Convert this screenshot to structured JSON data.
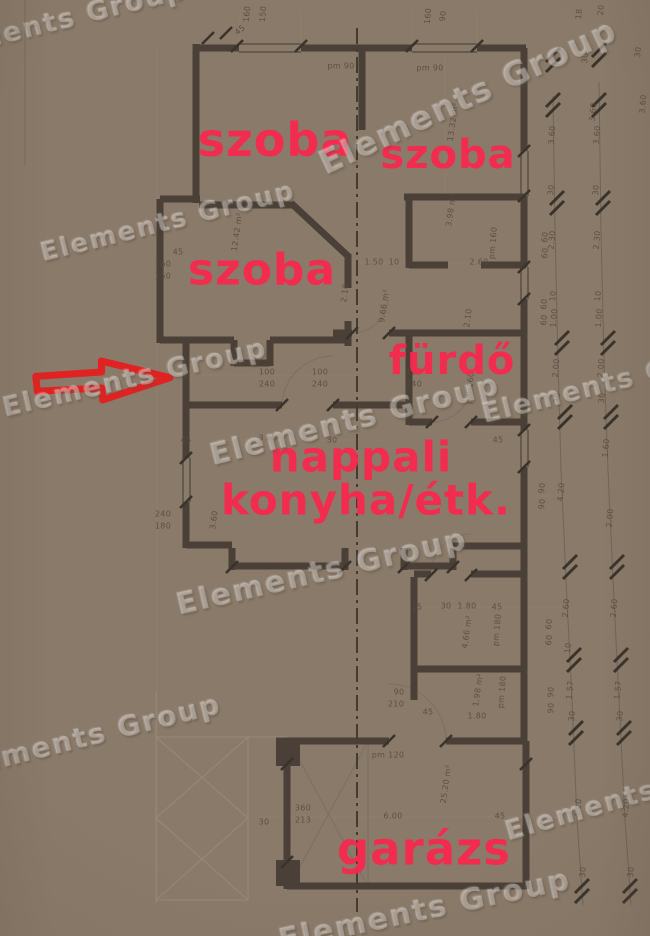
{
  "image": {
    "kind": "photographed floor plan",
    "width": 650,
    "height": 936
  },
  "watermark": {
    "text": "Elements Group",
    "instances": [
      {
        "x": 55,
        "y": 22,
        "r": -14,
        "s": 27
      },
      {
        "x": 468,
        "y": 96,
        "r": -25,
        "s": 33
      },
      {
        "x": 168,
        "y": 222,
        "r": -14,
        "s": 26
      },
      {
        "x": 135,
        "y": 378,
        "r": -13,
        "s": 27
      },
      {
        "x": 355,
        "y": 420,
        "r": -14,
        "s": 30
      },
      {
        "x": 614,
        "y": 382,
        "r": -14,
        "s": 27
      },
      {
        "x": 322,
        "y": 572,
        "r": -13,
        "s": 30
      },
      {
        "x": 85,
        "y": 737,
        "r": -14,
        "s": 28
      },
      {
        "x": 636,
        "y": 795,
        "r": -16,
        "s": 27
      },
      {
        "x": 425,
        "y": 910,
        "r": -12,
        "s": 30
      }
    ]
  },
  "plan": {
    "room_labels": [
      {
        "t": "szoba",
        "x": 275,
        "y": 140,
        "s": 46
      },
      {
        "t": "szoba",
        "x": 448,
        "y": 155,
        "s": 40
      },
      {
        "t": "szoba",
        "x": 262,
        "y": 270,
        "s": 44
      },
      {
        "t": "fürdő",
        "x": 452,
        "y": 361,
        "s": 40
      },
      {
        "t": "nappali",
        "x": 361,
        "y": 457,
        "s": 42
      },
      {
        "t": "konyha/étk.",
        "x": 366,
        "y": 500,
        "s": 42
      },
      {
        "t": "garázs",
        "x": 424,
        "y": 849,
        "s": 45
      }
    ],
    "annotation_arrow": {
      "color": "#e51f1f",
      "direction": "right"
    },
    "colors": {
      "paper": "#c8b7a5",
      "wall": "#4a4037",
      "thin_line": "#8f8171",
      "pencil": "#978b7d",
      "dim_text": "#564a3c",
      "label_red": "#f8284e"
    },
    "dim_labels": [
      {
        "t": "160",
        "x": 247,
        "y": 14,
        "r": -85
      },
      {
        "t": "150",
        "x": 263,
        "y": 14,
        "r": -85
      },
      {
        "t": "45",
        "x": 240,
        "y": 30,
        "r": -40
      },
      {
        "t": "160",
        "x": 428,
        "y": 16,
        "r": -85
      },
      {
        "t": "90",
        "x": 443,
        "y": 16,
        "r": -85
      },
      {
        "t": "pm 90",
        "x": 341,
        "y": 66
      },
      {
        "t": "pm 90",
        "x": 430,
        "y": 68
      },
      {
        "t": "18",
        "x": 579,
        "y": 14,
        "r": -85
      },
      {
        "t": "20",
        "x": 601,
        "y": 10,
        "r": -85
      },
      {
        "t": "30",
        "x": 585,
        "y": 58,
        "r": -85
      },
      {
        "t": "3.60",
        "x": 593,
        "y": 112,
        "r": -85
      },
      {
        "t": "30",
        "x": 638,
        "y": 52,
        "r": -85
      },
      {
        "t": "3.60",
        "x": 643,
        "y": 104,
        "r": -85
      },
      {
        "t": "12.42 m²",
        "x": 237,
        "y": 232,
        "r": -82
      },
      {
        "t": "13.32 m²",
        "x": 453,
        "y": 122,
        "r": -82
      },
      {
        "t": "3.98 m²",
        "x": 451,
        "y": 210,
        "r": -82
      },
      {
        "t": "9.66 m²",
        "x": 384,
        "y": 306,
        "r": -82
      },
      {
        "t": "45",
        "x": 178,
        "y": 252
      },
      {
        "t": "160",
        "x": 163,
        "y": 264
      },
      {
        "t": "150",
        "x": 163,
        "y": 276
      },
      {
        "t": "1.50",
        "x": 374,
        "y": 262
      },
      {
        "t": "10",
        "x": 394,
        "y": 262
      },
      {
        "t": "2.60",
        "x": 479,
        "y": 262
      },
      {
        "t": "pm 160",
        "x": 493,
        "y": 243,
        "r": -85
      },
      {
        "t": "2.10",
        "x": 345,
        "y": 293,
        "r": -82
      },
      {
        "t": "2.10",
        "x": 468,
        "y": 318,
        "r": -82
      },
      {
        "t": "pm 160",
        "x": 470,
        "y": 388,
        "r": -85
      },
      {
        "t": "100",
        "x": 267,
        "y": 372
      },
      {
        "t": "240",
        "x": 267,
        "y": 384
      },
      {
        "t": "100",
        "x": 320,
        "y": 372
      },
      {
        "t": "240",
        "x": 320,
        "y": 384
      },
      {
        "t": "100",
        "x": 414,
        "y": 372
      },
      {
        "t": "240",
        "x": 414,
        "y": 384
      },
      {
        "t": "45",
        "x": 186,
        "y": 440
      },
      {
        "t": "3.60",
        "x": 268,
        "y": 438
      },
      {
        "t": "30",
        "x": 332,
        "y": 440
      },
      {
        "t": "45",
        "x": 498,
        "y": 440
      },
      {
        "t": "240",
        "x": 163,
        "y": 514
      },
      {
        "t": "180",
        "x": 163,
        "y": 526
      },
      {
        "t": "3.60",
        "x": 214,
        "y": 520,
        "r": -82
      },
      {
        "t": "15",
        "x": 417,
        "y": 607
      },
      {
        "t": "30",
        "x": 446,
        "y": 606
      },
      {
        "t": "1.80",
        "x": 467,
        "y": 606
      },
      {
        "t": "45",
        "x": 497,
        "y": 607
      },
      {
        "t": "4.66 m²",
        "x": 467,
        "y": 632,
        "r": -82
      },
      {
        "t": "pm 180",
        "x": 497,
        "y": 630,
        "r": -85
      },
      {
        "t": "1.98 m²",
        "x": 478,
        "y": 690,
        "r": -82
      },
      {
        "t": "pm 180",
        "x": 502,
        "y": 692,
        "r": -85
      },
      {
        "t": "90",
        "x": 399,
        "y": 692
      },
      {
        "t": "210",
        "x": 396,
        "y": 704
      },
      {
        "t": "45",
        "x": 428,
        "y": 712
      },
      {
        "t": "1.80",
        "x": 477,
        "y": 716
      },
      {
        "t": "pm 120",
        "x": 388,
        "y": 755
      },
      {
        "t": "25.20 m²",
        "x": 446,
        "y": 784,
        "r": -82
      },
      {
        "t": "360",
        "x": 303,
        "y": 808
      },
      {
        "t": "213",
        "x": 303,
        "y": 820
      },
      {
        "t": "30",
        "x": 264,
        "y": 822
      },
      {
        "t": "6.00",
        "x": 393,
        "y": 816
      },
      {
        "t": "45",
        "x": 500,
        "y": 816
      },
      {
        "t": "60",
        "x": 545,
        "y": 237,
        "r": -85
      },
      {
        "t": "60",
        "x": 545,
        "y": 253,
        "r": -85
      },
      {
        "t": "60",
        "x": 544,
        "y": 304,
        "r": -85
      },
      {
        "t": "60",
        "x": 544,
        "y": 320,
        "r": -85
      },
      {
        "t": "90",
        "x": 542,
        "y": 488,
        "r": -85
      },
      {
        "t": "90",
        "x": 542,
        "y": 504,
        "r": -85
      },
      {
        "t": "60",
        "x": 549,
        "y": 624,
        "r": -85
      },
      {
        "t": "60",
        "x": 549,
        "y": 640,
        "r": -85
      },
      {
        "t": "90",
        "x": 551,
        "y": 692,
        "r": -85
      },
      {
        "t": "90",
        "x": 551,
        "y": 708,
        "r": -85
      },
      {
        "t": "3.60",
        "x": 552,
        "y": 135,
        "r": -85
      },
      {
        "t": "30",
        "x": 551,
        "y": 190,
        "r": -85
      },
      {
        "t": "2.30",
        "x": 552,
        "y": 240,
        "r": -85
      },
      {
        "t": "10",
        "x": 553,
        "y": 296,
        "r": -85
      },
      {
        "t": "1.00",
        "x": 554,
        "y": 318,
        "r": -85
      },
      {
        "t": "2.00",
        "x": 556,
        "y": 368,
        "r": -85
      },
      {
        "t": "30",
        "x": 557,
        "y": 398,
        "r": -85
      },
      {
        "t": "4.20",
        "x": 561,
        "y": 492,
        "r": -85
      },
      {
        "t": "2.60",
        "x": 566,
        "y": 608,
        "r": -85
      },
      {
        "t": "10",
        "x": 568,
        "y": 648,
        "r": -85
      },
      {
        "t": "1.57",
        "x": 570,
        "y": 690,
        "r": -85
      },
      {
        "t": "30",
        "x": 572,
        "y": 716,
        "r": -85
      },
      {
        "t": "4.20",
        "x": 578,
        "y": 808,
        "r": -85
      },
      {
        "t": "30",
        "x": 583,
        "y": 872,
        "r": -85
      },
      {
        "t": "3.60",
        "x": 597,
        "y": 135,
        "r": -85
      },
      {
        "t": "30",
        "x": 596,
        "y": 190,
        "r": -85
      },
      {
        "t": "2.30",
        "x": 597,
        "y": 240,
        "r": -85
      },
      {
        "t": "10",
        "x": 598,
        "y": 296,
        "r": -85
      },
      {
        "t": "1.00",
        "x": 599,
        "y": 318,
        "r": -85
      },
      {
        "t": "2.00",
        "x": 601,
        "y": 368,
        "r": -85
      },
      {
        "t": "30",
        "x": 602,
        "y": 398,
        "r": -85
      },
      {
        "t": "1.60",
        "x": 606,
        "y": 448,
        "r": -85
      },
      {
        "t": "2.00",
        "x": 610,
        "y": 518,
        "r": -85
      },
      {
        "t": "2.60",
        "x": 614,
        "y": 608,
        "r": -85
      },
      {
        "t": "1.57",
        "x": 618,
        "y": 690,
        "r": -85
      },
      {
        "t": "30",
        "x": 620,
        "y": 716,
        "r": -85
      },
      {
        "t": "4.20",
        "x": 626,
        "y": 808,
        "r": -85
      },
      {
        "t": "30",
        "x": 631,
        "y": 872,
        "r": -85
      }
    ]
  }
}
